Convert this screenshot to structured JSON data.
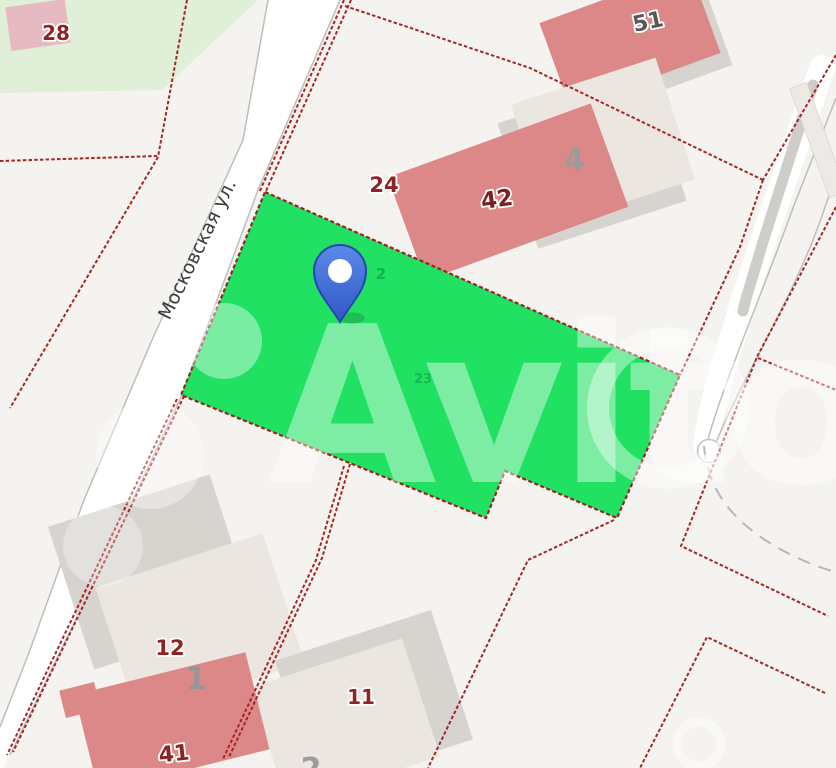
{
  "map": {
    "street_name": "Московская ул.",
    "watermark": "Avito",
    "house_numbers": {
      "h28": "28",
      "h51": "51",
      "h4": "4",
      "h24": "24",
      "h42": "42",
      "h12": "12",
      "h1": "1",
      "h41": "41",
      "h11": "11",
      "h2_partial": "2"
    },
    "highlighted_parcel": {
      "label_inner_top": "2",
      "label_inner_center": "23"
    },
    "colors": {
      "background": "#f5f3ef",
      "pale_green_area": "#e0efd8",
      "street_fill": "#ffffff",
      "boundary_red": "#a42525",
      "parcel_green": "#21e163",
      "parcel_border": "#9e2121",
      "building_red": "#dc8888",
      "building_beige": "#ebe7e0",
      "building_shadow": "#d7d4cf",
      "pink_building": "#e7b9c0",
      "label_dark_red": "#8d2323",
      "label_gray": "#979797",
      "pin_blue_light": "#5585e4",
      "pin_blue_dark": "#3258cb",
      "pin_border": "#2746ad"
    }
  }
}
